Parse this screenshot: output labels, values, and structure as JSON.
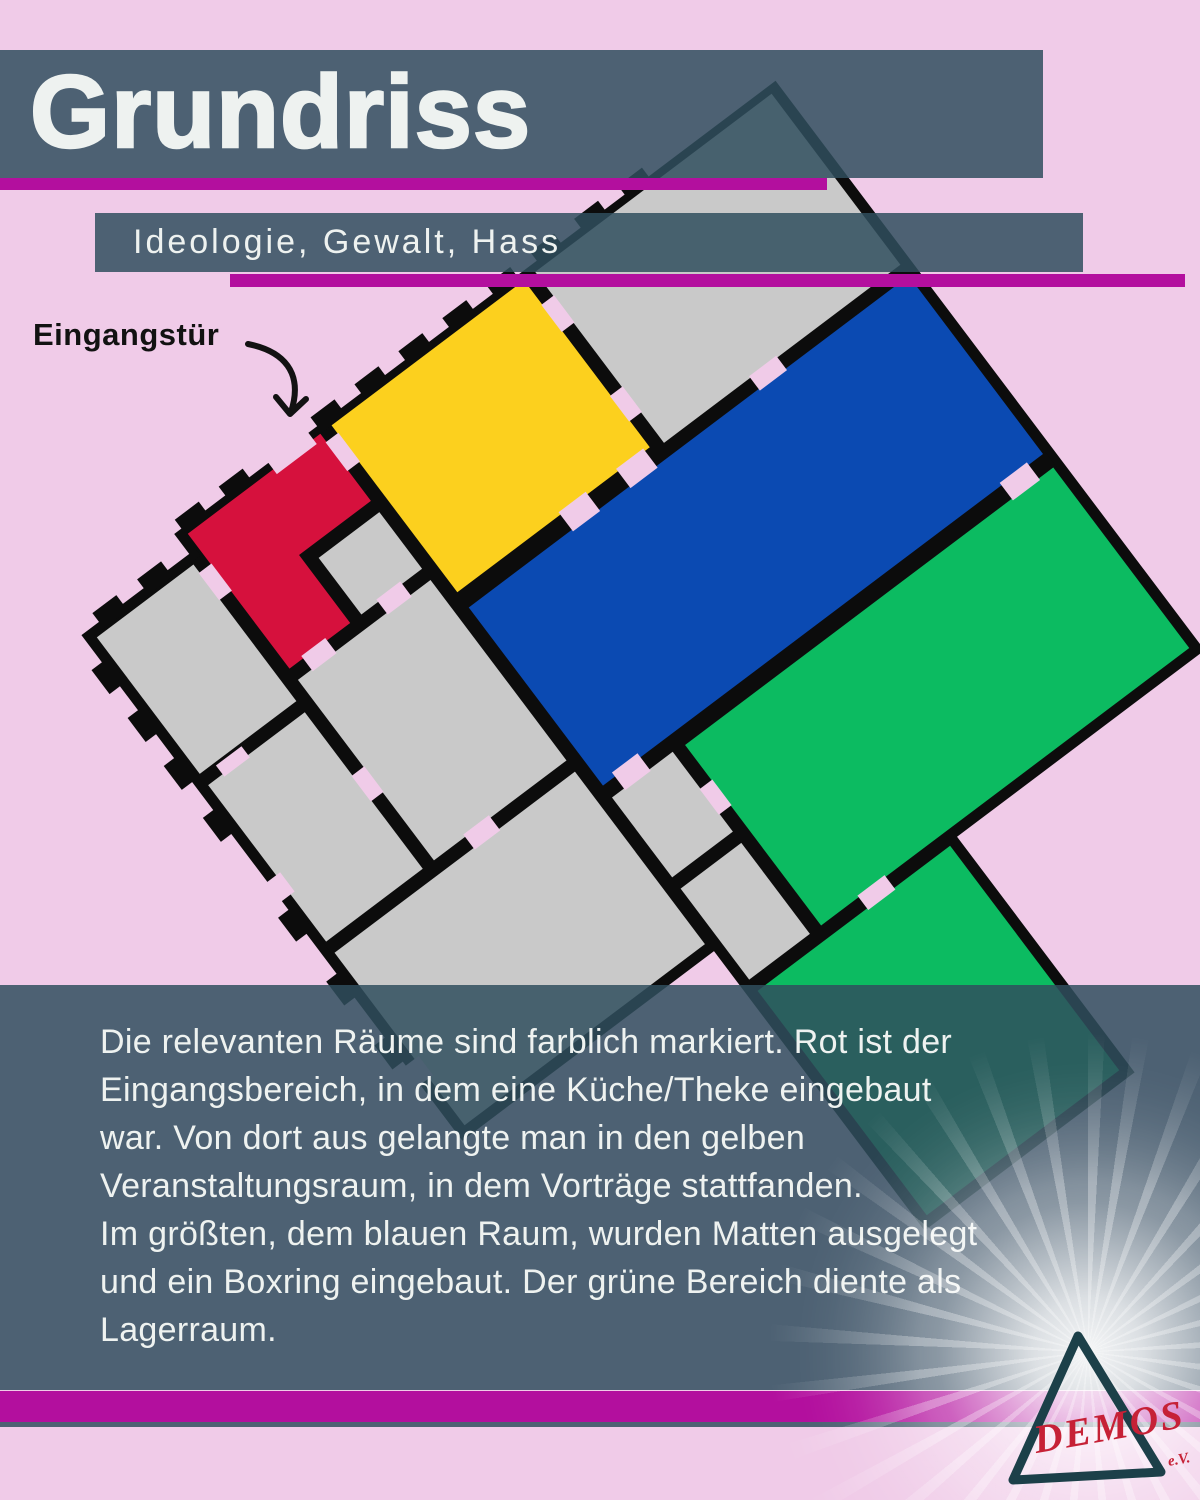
{
  "colors": {
    "bg": "#f0cbe8",
    "band": "rgba(48,79,94,0.85)",
    "magenta": "#b30f9e",
    "wall": "#0c0c0c",
    "room": "#c9c9c9",
    "red": "#d6113d",
    "yellow": "#fcd01e",
    "blue": "#0b4ab2",
    "green": "#0cbb61",
    "text_light": "#eef2f0",
    "label_dark": "#121212",
    "logo_red": "#c62136",
    "logo_teal": "#1c4049"
  },
  "header": {
    "title": "Grundriss",
    "subtitle": "Ideologie, Gewalt, Hass"
  },
  "annotation": {
    "entrance_label": "Eingangstür"
  },
  "floor_plan": {
    "rotation_deg": -37,
    "rooms": [
      {
        "id": "entrance-area",
        "color": "#d6113d"
      },
      {
        "id": "event-room",
        "color": "#fcd01e"
      },
      {
        "id": "large-room",
        "color": "#0b4ab2"
      },
      {
        "id": "storage-upper",
        "color": "#0cbb61"
      },
      {
        "id": "storage-lower",
        "color": "#0cbb61"
      },
      {
        "id": "unmarked-rooms",
        "color": "#c9c9c9"
      }
    ]
  },
  "description": {
    "lines": [
      "Die relevanten Räume sind farblich markiert. Rot ist der",
      "Eingangsbereich, in dem eine Küche/Theke eingebaut",
      "war. Von dort aus gelangte man in den gelben",
      "Veranstaltungsraum, in dem Vorträge stattfanden.",
      "Im größten, dem blauen Raum, wurden Matten ausgelegt",
      "und ein Boxring eingebaut. Der grüne Bereich diente als",
      "Lagerraum."
    ]
  },
  "logo": {
    "name": "DEMOS",
    "suffix": "e.V."
  }
}
